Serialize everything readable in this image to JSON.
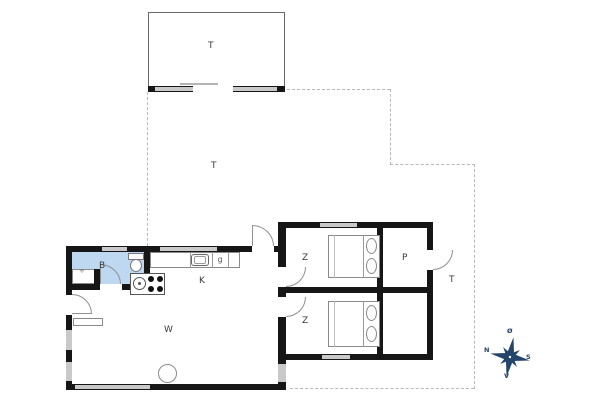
{
  "plan": {
    "rooms": {
      "bathroom": "B",
      "kitchen": "K",
      "living_room": "W",
      "bedroom_top": "Z",
      "bedroom_bottom": "Z",
      "storage": "P",
      "annex_terrace": "T",
      "main_terrace": "T",
      "side_terrace": "T",
      "kitchen_cell": "g"
    },
    "marks": {
      "shower_drain": "+"
    },
    "compass": {
      "north": "N",
      "south": "S",
      "east": "Ø",
      "west": "V"
    },
    "colors": {
      "wall": "#161616",
      "bathroom_fill": "#bfd8f2",
      "window": "#c9c9c9",
      "dashed_outline": "#b8b8b8",
      "furniture_line": "#8a8a8a",
      "compass": "#24456b"
    }
  }
}
